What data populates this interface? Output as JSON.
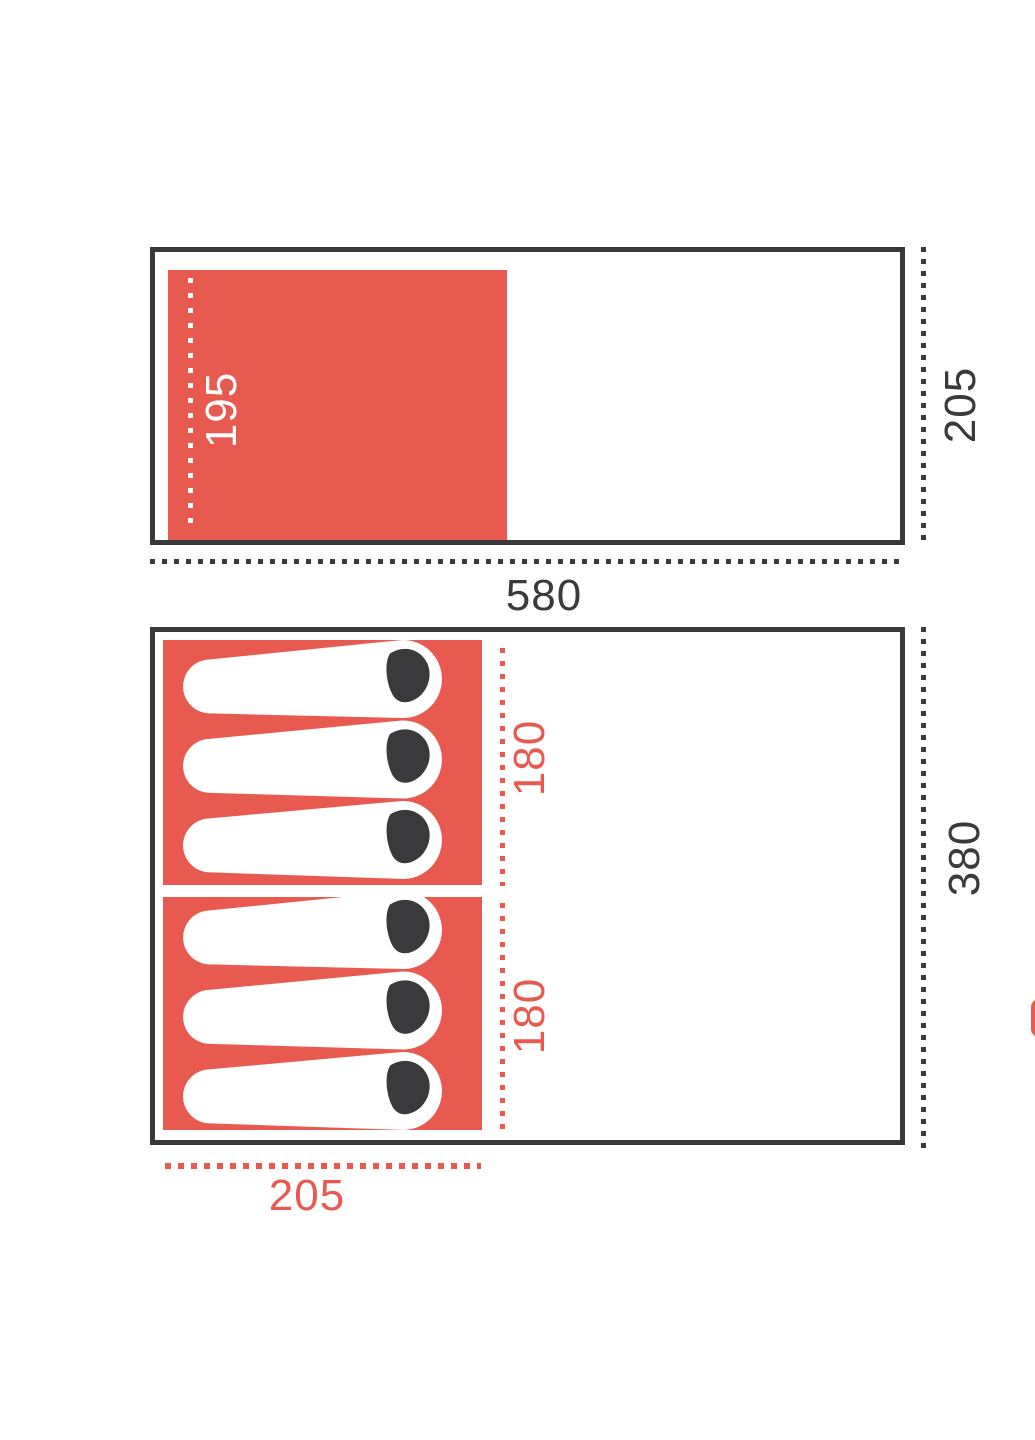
{
  "page": {
    "background": "#ffffff"
  },
  "colors": {
    "accent_red": "#e85a50",
    "dark_gray": "#3a3a3c",
    "bag_white": "#ffffff",
    "hood_dark": "#3a3a3c"
  },
  "top_plan": {
    "bedroom_depth_label": "195",
    "overall_depth_label": "205",
    "overall_width_label": "580"
  },
  "bottom_plan": {
    "bedroom1_length_label": "180",
    "bedroom2_length_label": "180",
    "overall_length_label": "380",
    "bedroom_width_label": "205",
    "beds_per_room": 3
  }
}
